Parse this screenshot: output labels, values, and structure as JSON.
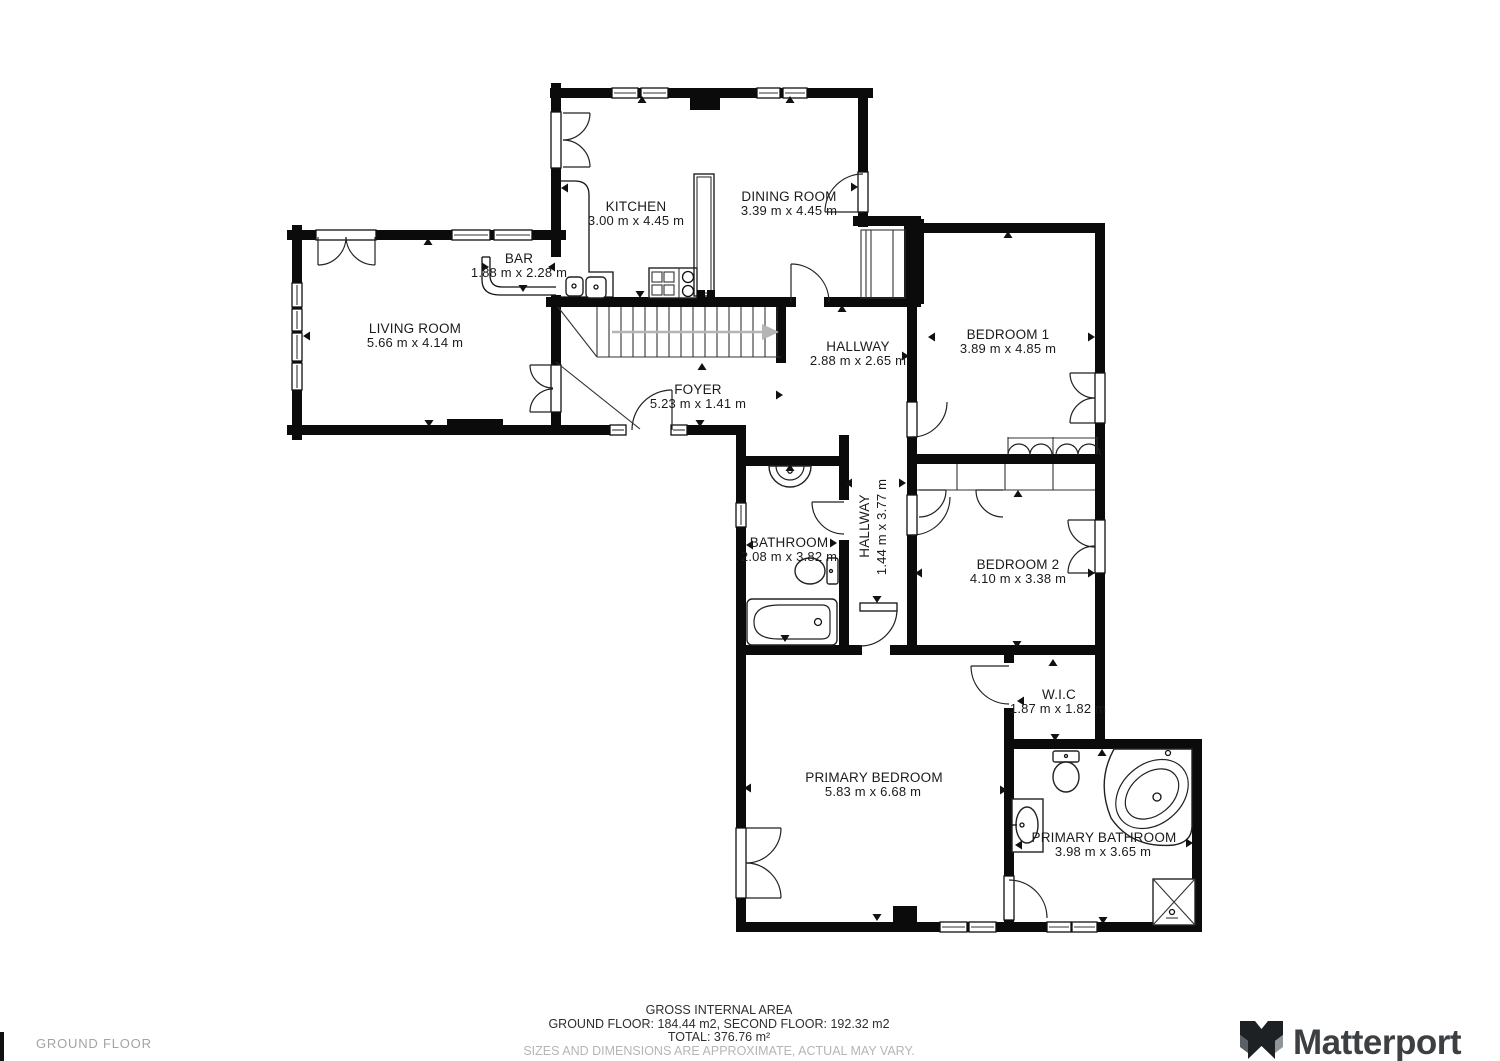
{
  "floorplan": {
    "rooms": [
      {
        "id": "kitchen",
        "name": "KITCHEN",
        "dims": "3.00 m x 4.45 m"
      },
      {
        "id": "dining-room",
        "name": "DINING ROOM",
        "dims": "3.39 m x 4.45 m"
      },
      {
        "id": "bar",
        "name": "BAR",
        "dims": "1.88 m x 2.28 m"
      },
      {
        "id": "living-room",
        "name": "LIVING ROOM",
        "dims": "5.66 m x 4.14 m"
      },
      {
        "id": "foyer",
        "name": "FOYER",
        "dims": "5.23 m x 1.41 m"
      },
      {
        "id": "hallway",
        "name": "HALLWAY",
        "dims": "2.88 m x 2.65 m"
      },
      {
        "id": "bedroom-1",
        "name": "BEDROOM 1",
        "dims": "3.89 m x 4.85 m"
      },
      {
        "id": "bathroom",
        "name": "BATHROOM",
        "dims": "2.08 m x 3.82 m"
      },
      {
        "id": "hallway-2",
        "name": "HALLWAY",
        "dims": "1.44 m x 3.77 m"
      },
      {
        "id": "bedroom-2",
        "name": "BEDROOM 2",
        "dims": "4.10 m x 3.38 m"
      },
      {
        "id": "wic",
        "name": "W.I.C",
        "dims": "1.87 m x 1.82 m"
      },
      {
        "id": "primary-bedroom",
        "name": "PRIMARY BEDROOM",
        "dims": "5.83 m x 6.68 m"
      },
      {
        "id": "primary-bathroom",
        "name": "PRIMARY BATHROOM",
        "dims": "3.98 m x 3.65 m"
      }
    ]
  },
  "footer": {
    "area_title": "GROSS INTERNAL AREA",
    "area_line": "GROUND FLOOR: 184.44 m2, SECOND FLOOR: 192.32 m2",
    "area_total": "TOTAL: 376.76 m²",
    "disclaimer": "SIZES AND DIMENSIONS ARE APPROXIMATE, ACTUAL MAY VARY.",
    "floor_label": "GROUND FLOOR",
    "brand": "Matterport"
  }
}
